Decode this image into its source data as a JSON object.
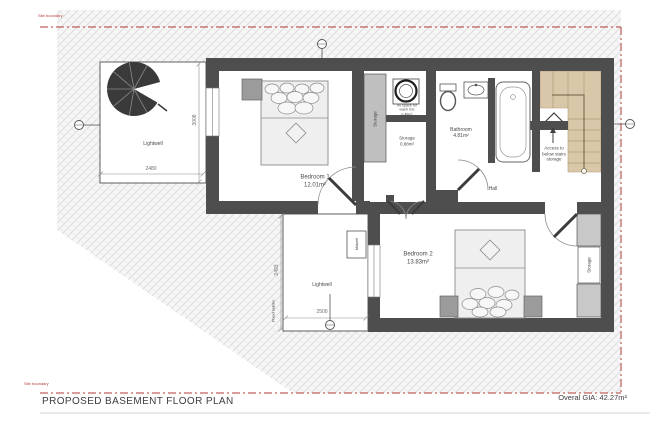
{
  "drawing": {
    "title": "PROPOSED BASEMENT FLOOR PLAN",
    "gia_label": "Overal GIA: 42.27m²",
    "boundary_label_top": "Site boundary",
    "boundary_label_bottom": "Site boundary"
  },
  "rooms": {
    "bedroom1_name": "Bedroom 1",
    "bedroom1_area": "12.01m²",
    "bedroom2_name": "Bedroom 2",
    "bedroom2_area": "13.83m²",
    "bathroom_name": "Bathroom",
    "bathroom_area": "4.81m²",
    "storage_name": "Storage",
    "storage_area": "0.88m²",
    "closet_label": "Storage",
    "bedroom2_storage_label": "Storage",
    "hall_label": "Hall",
    "lightwell_upper_label": "Lightwell",
    "lightwell_lower_label": "Lightwell"
  },
  "annotations": {
    "wash_line1": "Av space for",
    "wash_line2": "wash m/c",
    "wash_line3": "0.48m²",
    "stairs_line1": "Access to",
    "stairs_line2": "below stairs",
    "stairs_line3": "storage",
    "fixed_ladder": "Fixed ladder",
    "matwell": "Matwell"
  },
  "dimensions": {
    "upper_lightwell_width": "2480",
    "upper_lightwell_depth": "3008",
    "lower_lightwell_width": "2500",
    "lower_lightwell_depth": "2493"
  },
  "colors": {
    "wall": "#4e4e4e",
    "stair_fill": "#d9c7a9",
    "boundary_red": "#b23b34",
    "hatch_line": "#dcdcdc"
  }
}
